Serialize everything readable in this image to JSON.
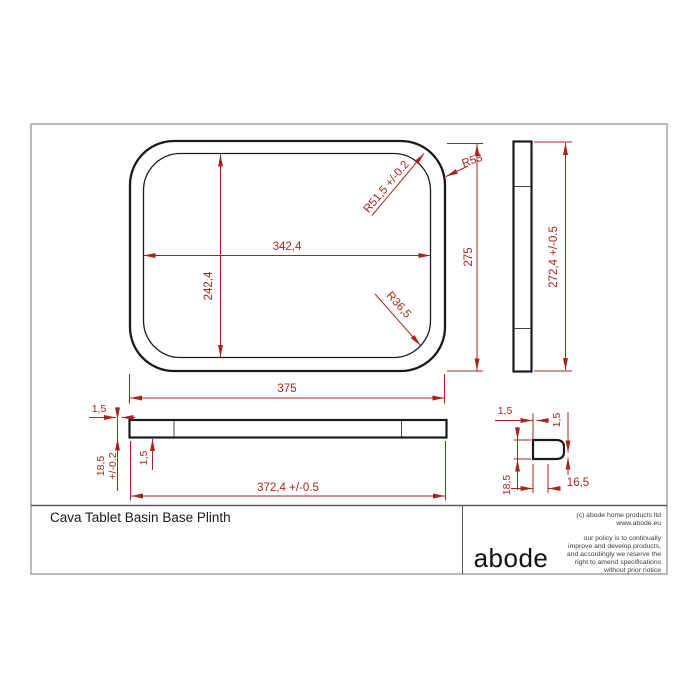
{
  "sheet": {
    "title": "Cava Tablet Basin Base Plinth",
    "logo": "abode",
    "copyright_line1": "(c) abode home products ltd",
    "copyright_line2": "www.abode.eu",
    "policy_lines": [
      "our policy is to continually",
      "improve and develop products,",
      "and accordingly we reserve the",
      "right to amend specifications",
      "without prior notice"
    ]
  },
  "colors": {
    "dimension_red": "#a8251f",
    "outline_black": "#1a1a1a",
    "border_gray": "#8c8c8c"
  },
  "views": {
    "top": {
      "inner_width": "342,4",
      "inner_height": "242,4",
      "outer_height": "275",
      "outer_width": "375",
      "radius_outer": "R53",
      "radius_inner": "R51,5 +/-0.2",
      "radius_base": "R36,5"
    },
    "side": {
      "height": "272,4 +/-0.5"
    },
    "front": {
      "top_lip": "1,5",
      "thickness": "18,5",
      "thickness_tol": "+/-0.2",
      "bottom_lip": "1,5",
      "width": "372,4 +/-0.5"
    },
    "section": {
      "wall_top": "1,5",
      "wall_right": "1,5",
      "height": "18,5",
      "width": "16,5"
    }
  }
}
